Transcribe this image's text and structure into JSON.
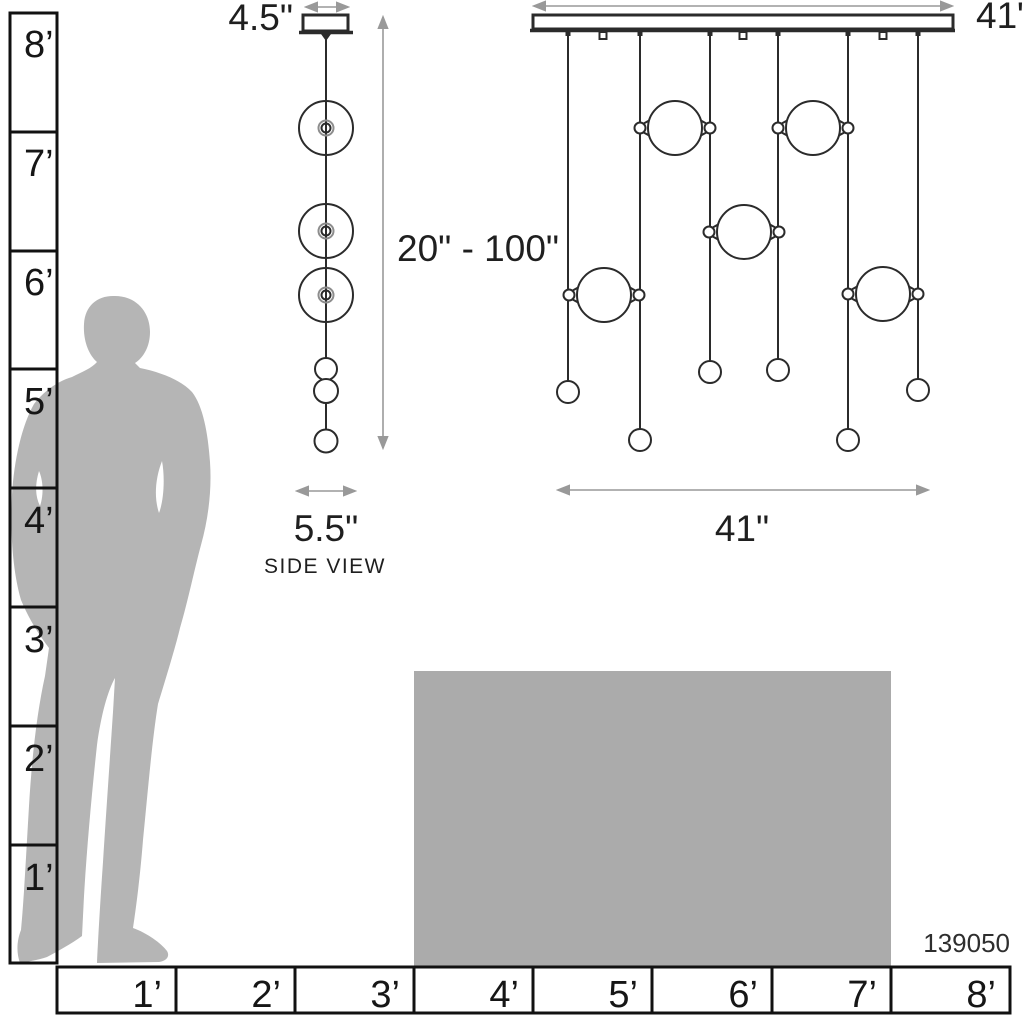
{
  "side_view": {
    "canopy_width": "4.5\"",
    "height_range": "20\" - 100\"",
    "fixture_width": "5.5\"",
    "caption": "SIDE VIEW"
  },
  "front_view": {
    "canopy_width": "41\"",
    "fixture_width": "41\""
  },
  "vertical_ruler": {
    "labels": [
      "8’",
      "7’",
      "6’",
      "5’",
      "4’",
      "3’",
      "2’",
      "1’"
    ]
  },
  "horizontal_ruler": {
    "labels": [
      "1’",
      "2’",
      "3’",
      "4’",
      "5’",
      "6’",
      "7’",
      "8’"
    ]
  },
  "product_number": "139050",
  "colors": {
    "line": "#2b2b2b",
    "dim": "#999999",
    "text": "#1f1f1f",
    "silhouette": "#b5b5b5",
    "table": "#ababab",
    "hub": "#8d8d8d"
  }
}
